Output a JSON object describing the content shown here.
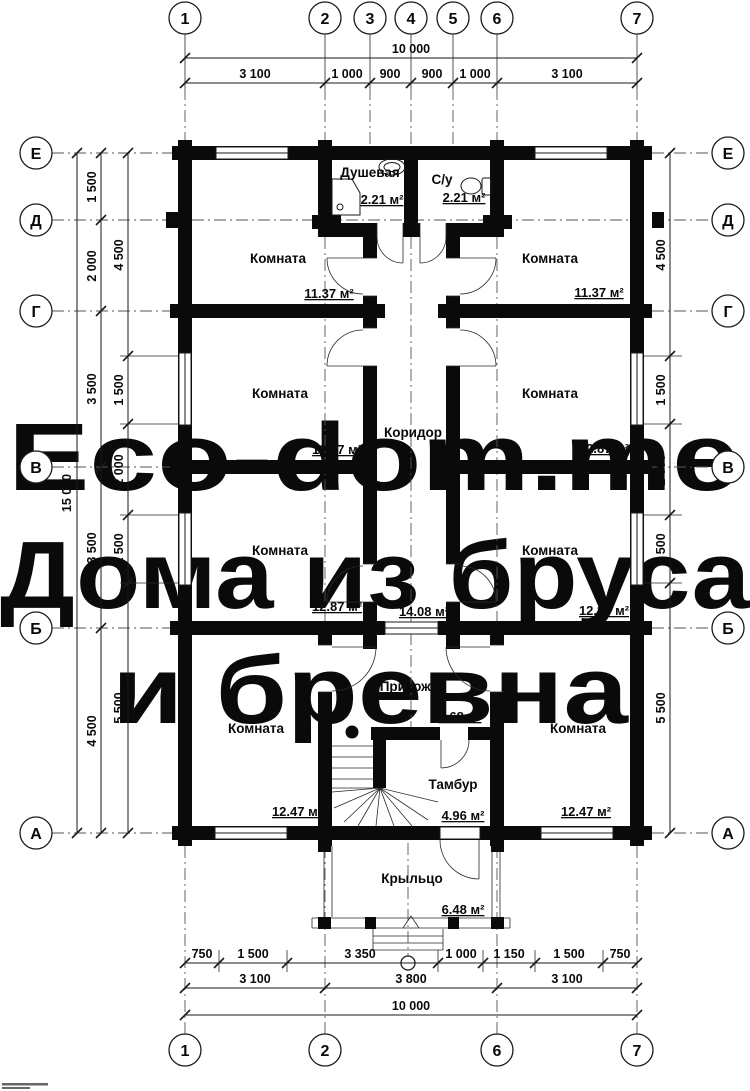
{
  "title": "План первого этажа",
  "watermark": {
    "color": "#f7ced2",
    "lines": [
      "Eco-dom.me",
      "Дома из бруса",
      "и бревна"
    ]
  },
  "axes": {
    "top": [
      "1",
      "2",
      "3",
      "4",
      "5",
      "6",
      "7"
    ],
    "bottom": [
      "1",
      "2",
      "6",
      "7"
    ],
    "left": [
      "Е",
      "Д",
      "Г",
      "В",
      "Б",
      "А"
    ],
    "right": [
      "Е",
      "Д",
      "Г",
      "В",
      "Б",
      "А"
    ]
  },
  "dims": {
    "top_total": "10 000",
    "top_row": [
      "3 100",
      "1 000",
      "900",
      "900",
      "1 000",
      "3 100"
    ],
    "left_total": "15 000",
    "left_axis_row": [
      "1 500",
      "2 000",
      "3 500",
      "3 500",
      "4 500"
    ],
    "left_window_row": [
      "4 500",
      "1 500",
      "2 000",
      "1 500",
      "5 500"
    ],
    "right_row": [
      "4 500",
      "1 500",
      "2 000",
      "1 500",
      "5 500"
    ],
    "bottom_detail_row": [
      "750",
      "1 500",
      "3 350",
      "1 000",
      "1 150",
      "1 500",
      "750"
    ],
    "bottom_axis_row": [
      "3 100",
      "3 800",
      "3 100"
    ],
    "bottom_total": "10 000"
  },
  "rooms": [
    {
      "name": "Душевая",
      "area": "2.21 м²"
    },
    {
      "name": "С/у",
      "area": "2.21 м²"
    },
    {
      "name": "Комната",
      "area": "11.37 м²"
    },
    {
      "name": "Комната",
      "area": "11.37 м²"
    },
    {
      "name": "Комната",
      "area": "12.87 м²"
    },
    {
      "name": "Комната",
      "area": "12.87 м²"
    },
    {
      "name": "Коридор",
      "area": "14.08 м²"
    },
    {
      "name": "Комната",
      "area": "12.87 м²"
    },
    {
      "name": "Комната",
      "area": "12.87 м²"
    },
    {
      "name": "Прихожая",
      "area": "7.68 м²"
    },
    {
      "name": "Тамбур",
      "area": "4.96 м²"
    },
    {
      "name": "Комната",
      "area": "12.47 м²"
    },
    {
      "name": "Комната",
      "area": "12.47 м²"
    },
    {
      "name": "Крыльцо",
      "area": "6.48 м²"
    }
  ],
  "colors": {
    "ink": "#0a0a0a",
    "background": "#ffffff"
  }
}
